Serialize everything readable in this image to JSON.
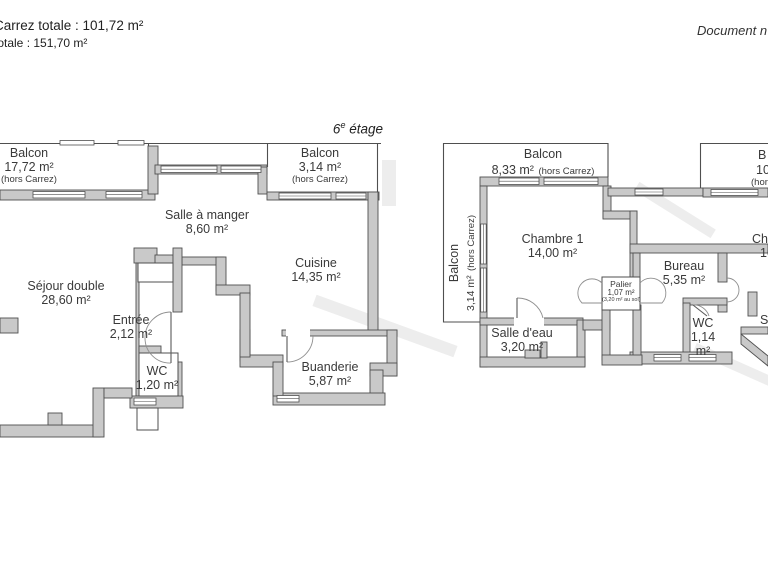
{
  "header": {
    "carrez_line": "Carrez totale :  101,72 m²",
    "total_line": "totale :  151,70 m²",
    "doc_note": "Document n"
  },
  "floor_label": {
    "num": "6",
    "sup": "e",
    "rest": " étage"
  },
  "left_plan": {
    "balcon_1": {
      "name": "Balcon",
      "area": "17,72 m²",
      "note": "(hors Carrez)"
    },
    "balcon_2": {
      "name": "Balcon",
      "area": "3,14 m²",
      "note": "(hors Carrez)"
    },
    "salle_a_manger": {
      "name": "Salle à manger",
      "area": "8,60 m²"
    },
    "cuisine": {
      "name": "Cuisine",
      "area": "14,35 m²"
    },
    "sejour": {
      "name": "Séjour double",
      "area": "28,60 m²"
    },
    "entree": {
      "name": "Entrée",
      "area": "2,12 m²"
    },
    "wc": {
      "name": "WC",
      "area": "1,20 m²"
    },
    "buanderie": {
      "name": "Buanderie",
      "area": "5,87 m²"
    }
  },
  "right_plan": {
    "balcon_top": {
      "name": "Balcon",
      "area": "8,33 m²",
      "note": "(hors Carrez)"
    },
    "balcon_left": {
      "name": "Balcon",
      "area": "3,14 m²",
      "note": "(hors Carrez)"
    },
    "chambre_1": {
      "name": "Chambre 1",
      "area": "14,00 m²"
    },
    "palier": {
      "name": "Palier",
      "area": "1,07 m²",
      "note": "(3,20 m² au sol)"
    },
    "bureau": {
      "name": "Bureau",
      "area": "5,35 m²"
    },
    "salle_deau": {
      "name": "Salle d'eau",
      "area": "3,20 m²"
    },
    "wc": {
      "name": "WC",
      "area_line1": "1,14",
      "area_line2": "m²"
    },
    "balcon_cut": {
      "line1": "B",
      "line2": "10",
      "line3": "(hor"
    },
    "chambre_cut": {
      "line1": "Cha",
      "line2": "10"
    },
    "room_cut": {
      "line1": "S"
    }
  },
  "colors": {
    "wall_fill": "#c9c9c9",
    "wall_stroke": "#4f4f4f",
    "text": "#3a3a3a"
  }
}
